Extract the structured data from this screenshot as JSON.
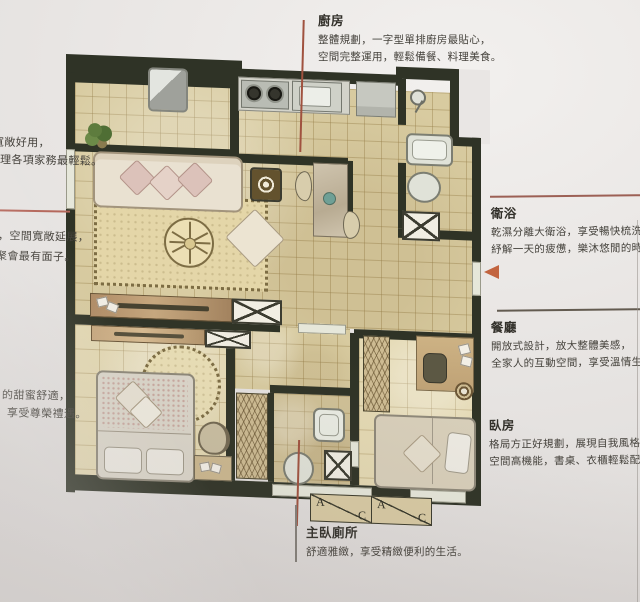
{
  "page": {
    "background_base": "#e8e5e3",
    "wall_color": "#2f3326",
    "leader_line_color": "#a0523f",
    "arrow_color": "#c2643f",
    "heading_color": "#32302a",
    "body_text_color": "#45423c"
  },
  "annotations": {
    "kitchen": {
      "title": "廚房",
      "line1": "整體規劃，一字型單排廚房最貼心，",
      "line2": "空間完整運用，輕鬆備餐、料理美食。"
    },
    "bathroom": {
      "title": "衛浴",
      "line1": "乾濕分離大衛浴，享受暢快梳洗，",
      "line2": "紓解一天的疲憊，樂沐悠閒的時光。"
    },
    "dining": {
      "title": "餐廳",
      "line1": "開放式設計，放大整體美感，",
      "line2": "全家人的互動空間，享受溫情生活。"
    },
    "bedroom": {
      "title": "臥房",
      "line1": "格局方正好規劃，展現自我風格，",
      "line2": "空間高機能，書桌、衣櫃輕鬆配置。"
    },
    "master_toilet": {
      "title": "主臥廁所",
      "line1": "舒適雅緻，享受精緻便利的生活。"
    },
    "left_top": {
      "line1": "寬敞好用，",
      "line2": "理各項家務最輕鬆。"
    },
    "left_mid": {
      "line1": "，空間寬敞延展，",
      "line2": "聚會最有面子。"
    },
    "left_bottom": {
      "line1": "的甜蜜舒適，",
      "line2": "享受尊榮禮遇。"
    }
  },
  "plan": {
    "ac_units": {
      "box1_a": "A",
      "box1_c": "C",
      "box2_a": "A",
      "box2_c": "C"
    },
    "fixtures": [
      "sofa",
      "rug",
      "tv-console",
      "dining-table",
      "stove",
      "sink",
      "refrigerator",
      "bathtub",
      "toilet",
      "shower",
      "bed",
      "wardrobe",
      "desk",
      "plant",
      "ac-unit",
      "shaft"
    ]
  }
}
